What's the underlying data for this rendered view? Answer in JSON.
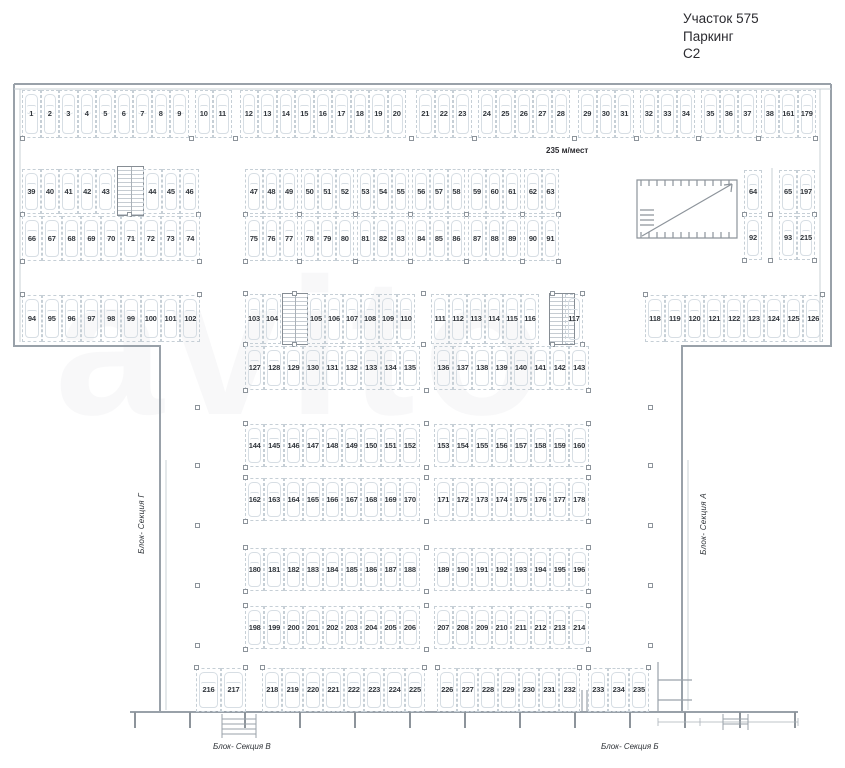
{
  "title": {
    "line1": "Участок 575",
    "line2": "Паркинг",
    "line3": "С2"
  },
  "capacity_label": "235 м/мест",
  "watermark": "avito",
  "sections": {
    "left": "Блок- Секция Г",
    "right": "Блок- Секция А",
    "bottom_left": "Блок- Секция В",
    "bottom_right": "Блок- Секция Б"
  },
  "colors": {
    "wall": "#99a1a9",
    "wall_light": "#c9d0d6",
    "space_border": "#c6cfd6",
    "car_outline": "#d7dee4",
    "number": "#33383e",
    "title_text": "#2b2b30"
  },
  "parking": {
    "total_spaces": 235,
    "groups": {
      "top_row": [
        1,
        2,
        3,
        4,
        5,
        6,
        7,
        8,
        9,
        10,
        11,
        12,
        13,
        14,
        15,
        16,
        17,
        18,
        19,
        20,
        21,
        22,
        23,
        24,
        25,
        26,
        27,
        28,
        29,
        30,
        31,
        32,
        33,
        34,
        35,
        36,
        37,
        38,
        161,
        179
      ],
      "b2_left_top": [
        39,
        40,
        41,
        42,
        43,
        44,
        45,
        46
      ],
      "b2_mid_top": [
        47,
        48,
        49,
        50,
        51,
        52,
        53,
        54,
        55,
        56,
        57,
        58,
        59,
        60,
        61,
        62,
        63
      ],
      "b2_right_top": [
        64,
        65,
        197
      ],
      "b2_left_bottom": [
        66,
        67,
        68,
        69,
        70,
        71,
        72,
        73,
        74
      ],
      "b2_mid_bottom": [
        75,
        76,
        77,
        78,
        79,
        80,
        81,
        82,
        83,
        84,
        85,
        86,
        87,
        88,
        89,
        90,
        91
      ],
      "b2_right_bottom": [
        92,
        93,
        215
      ],
      "b3_left": [
        94,
        95,
        96,
        97,
        98,
        99,
        100,
        101,
        102
      ],
      "b3_mid_top": [
        103,
        104,
        105,
        106,
        107,
        108,
        109,
        110,
        111,
        112,
        113,
        114,
        115,
        116,
        117
      ],
      "b3_right": [
        118,
        119,
        120,
        121,
        122,
        123,
        124,
        125,
        126
      ],
      "b3_mid_bottom": [
        127,
        128,
        129,
        130,
        131,
        132,
        133,
        134,
        135,
        136,
        137,
        138,
        139,
        140,
        141,
        142,
        143
      ],
      "row_144": [
        144,
        145,
        146,
        147,
        148,
        149,
        150,
        151,
        152,
        153,
        154,
        155,
        156,
        157,
        158,
        159,
        160
      ],
      "row_162": [
        162,
        163,
        164,
        165,
        166,
        167,
        168,
        169,
        170,
        171,
        172,
        173,
        174,
        175,
        176,
        177,
        178
      ],
      "row_180": [
        180,
        181,
        182,
        183,
        184,
        185,
        186,
        187,
        188,
        189,
        190,
        191,
        192,
        193,
        194,
        195,
        196
      ],
      "row_198": [
        198,
        199,
        200,
        201,
        202,
        203,
        204,
        205,
        206,
        207,
        208,
        209,
        210,
        211,
        212,
        213,
        214
      ],
      "bottom_1": [
        216,
        217
      ],
      "bottom_2": [
        218,
        219,
        220,
        221,
        222,
        223,
        224,
        225
      ],
      "bottom_3": [
        226,
        227,
        228,
        229,
        230,
        231,
        232
      ],
      "bottom_4": [
        233,
        234,
        235
      ]
    }
  }
}
